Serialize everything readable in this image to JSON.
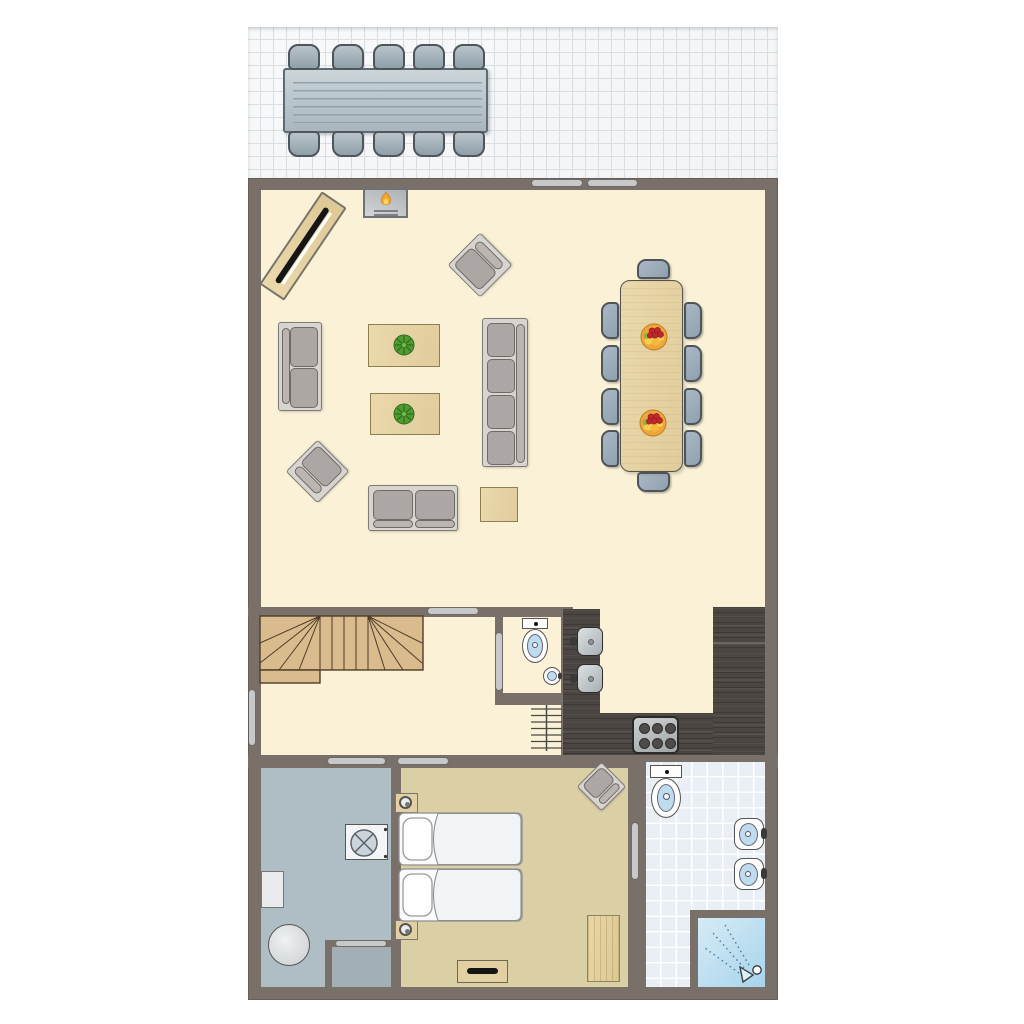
{
  "scene": {
    "kind": "floor-plan",
    "view": "top-down",
    "visible_text": ""
  },
  "palette": {
    "wall": "#7A706A",
    "wall_edge": "#675E58",
    "living_floor": "#FBF1D6",
    "bedroom_floor": "#DBCFA6",
    "utility_floor": "#AFBDC5",
    "closet_floor": "#A3AFB7",
    "bathroom_floor": "#E9EFF5",
    "bathroom_grid": "#FFFFFF",
    "terrace_tile": "#F2F4F6",
    "terrace_line": "#D9DEE2",
    "kitchen_counter": "#4B4642",
    "kitchen_seam": "#6B6661",
    "stairs_wood": "#D9BB8E",
    "stairs_line": "#4F3D28",
    "table_wood": "#E8D6A9",
    "table_wood_border": "#8A8052",
    "door_bar": "#C6C8CA",
    "sofa_frame": "#D8D5D1",
    "sofa_frame_border": "#7F7C78",
    "sofa_cushion": "#ACA7A4",
    "cushion_border": "#6E6A67",
    "chair_blue": "#9FAEBC",
    "chair_border": "#4F545A",
    "water_blue": "#BFDCEE",
    "shower_blue_1": "#D6EBF6",
    "shower_blue_2": "#A7D4EC",
    "appliance_white": "#F4F5F6",
    "wood_cabinet": "#E2D0A2",
    "black_accent": "#151515",
    "plant_green": "#4E9B30",
    "flame_orange": "#F7A82B",
    "fruit_orange": "#F0A53C",
    "fruit_red": "#C1272D"
  },
  "rooms": [
    {
      "name": "terrace"
    },
    {
      "name": "living-room"
    },
    {
      "name": "dining-area"
    },
    {
      "name": "open-kitchen"
    },
    {
      "name": "hallway-with-stairs"
    },
    {
      "name": "wc"
    },
    {
      "name": "utility-room"
    },
    {
      "name": "closet"
    },
    {
      "name": "bedroom"
    },
    {
      "name": "bathroom"
    }
  ],
  "furniture": {
    "terrace": [
      "outdoor-dining-table",
      "outdoor-chair x10"
    ],
    "living_room": [
      "fireplace",
      "tv-sideboard-diagonal",
      "armchair x2",
      "sofa-2-seat x2",
      "sofa-4-seat",
      "coffee-table-with-plant x2",
      "side-table"
    ],
    "dining_area": [
      "dining-table",
      "dining-chair x10",
      "fruit-bowl x2"
    ],
    "open_kitchen": [
      "counter-left-with-2-sinks",
      "counter-bottom",
      "counter-right",
      "stove-6-burners"
    ],
    "hallway": [
      "winder-staircase",
      "radiator"
    ],
    "wc": [
      "toilet",
      "corner-hand-basin"
    ],
    "utility_room": [
      "washing-machine",
      "boiler",
      "side-table"
    ],
    "bedroom": [
      "double-bed",
      "nightstand-with-lamp x2",
      "armchair",
      "wardrobe",
      "dresser-with-tv"
    ],
    "bathroom": [
      "toilet",
      "wash-basin x2",
      "shower-corner"
    ]
  },
  "openings": {
    "windows_or_doors_bars": 9,
    "locations": [
      "terrace-wall x2",
      "living-to-hall",
      "hall-left-window",
      "wc-door",
      "utility-door",
      "bedroom-door",
      "bathroom-door",
      "closet-hatch"
    ]
  }
}
